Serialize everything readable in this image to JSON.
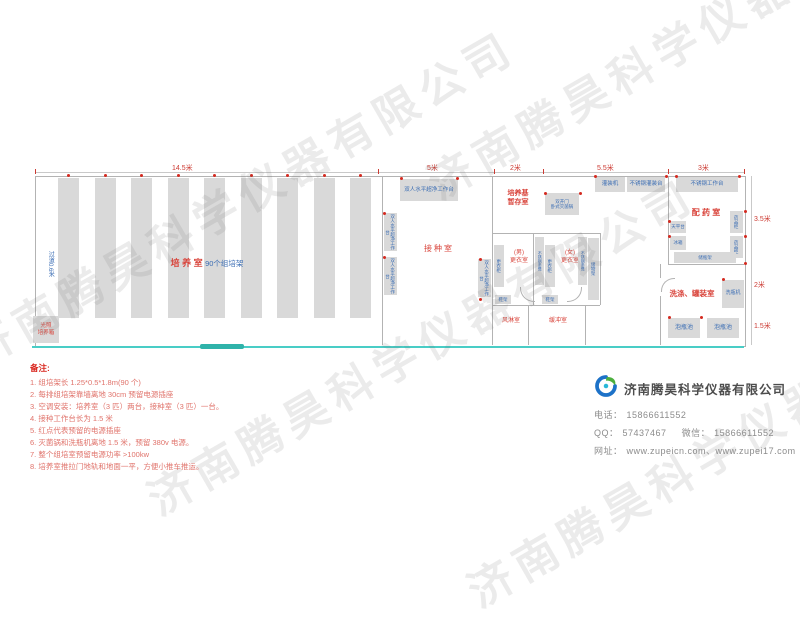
{
  "watermark": {
    "text": "济南腾昊科学仪器有限公司"
  },
  "plan": {
    "top_dimensions": [
      "14.5米",
      "5米",
      "2米",
      "5.5米",
      "3米"
    ],
    "right_dimensions": [
      "3.5米",
      "2米",
      "1.5米"
    ],
    "culture_room": {
      "name": "培 养 室",
      "racks_label": "90个组培架",
      "aisle": "过道0.6米",
      "incubator_line1": "光照",
      "incubator_line2": "培养箱"
    },
    "inoculation_room": {
      "name": "接种室",
      "bench": "双人水平超净工作台"
    },
    "medium_storage": {
      "line1": "培养基",
      "line2": "暂存室"
    },
    "sterilizer": {
      "line1": "双开门",
      "line2": "卧式灭菌锅"
    },
    "filling_machine": "灌装机",
    "filling_table": "不锈钢灌装台",
    "work_table": "不锈钢工作台",
    "pharmacy_room": {
      "name": "配 药 室",
      "balance": "天平台",
      "fridge": "冰箱",
      "cabinet": "药品柜",
      "bottle_rack": "储瓶架"
    },
    "washing_room": {
      "name": "洗涤、罐装室",
      "washer": "洗瓶机",
      "pool": "泡瓶池"
    },
    "changing": {
      "men_line1": "(男)",
      "men_line2": "更衣室",
      "women_line1": "(女)",
      "women_line2": "更衣室",
      "wardrobe": "更衣柜",
      "bench": "不锈钢条凳",
      "storage": "储物架",
      "shoe_rack": "鞋架",
      "air_shower": "风淋室",
      "buffer": "缓冲室"
    }
  },
  "notes": {
    "title": "备注:",
    "items": [
      "1. 组培架长 1.25*0.5*1.8m(90 个)",
      "2. 每排组培架靠墙离地 30cm 预留电源插座",
      "3. 空调安装：培养室（3 匹）两台，接种室（3 匹）一台。",
      "4. 接种工作台长为 1.5 米",
      "5. 红点代表预留的电源插座",
      "6. 灭菌锅和洗瓶机离地 1.5 米，预留 380v 电源。",
      "7. 整个组培室预留电源功率 >100kw",
      "8. 培养室推拉门地轨和地面一平，方便小推车推运。"
    ]
  },
  "company": {
    "name": "济南腾昊科学仪器有限公司",
    "phone_label": "电话：",
    "phone": "15866611552",
    "qq_label": "QQ：",
    "qq": "57437467",
    "wechat_label": "微信：",
    "wechat": "15866611552",
    "web_label": "网址：",
    "websites": "www.zupeicn.com、www.zupei17.com"
  }
}
